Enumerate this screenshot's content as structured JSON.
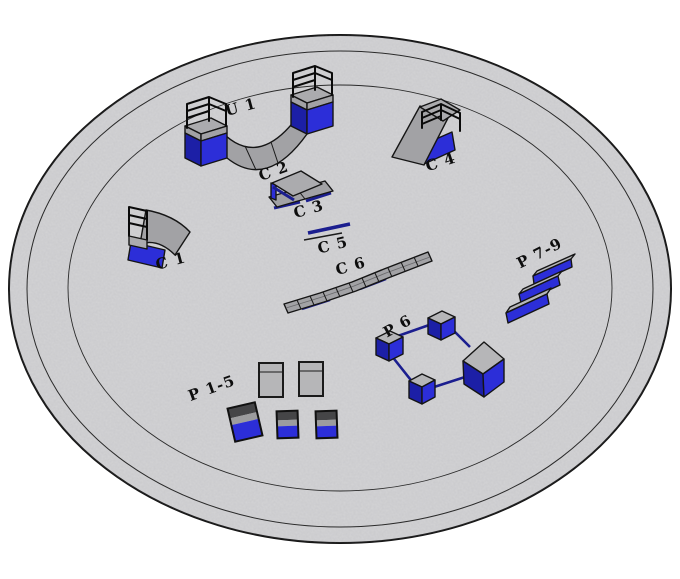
{
  "figure": {
    "title": "3D layout of skatepark equipment on circular pad",
    "platform": {
      "shape": "ellipse",
      "fill": "#d4d4d6",
      "ring_count": 2
    },
    "colors": {
      "platform_fill": "#d4d4d6",
      "equipment_gray": "#a2a2a5",
      "cube_top_gray": "#b6b6b8",
      "equipment_blue": "#2c2ed8",
      "equipment_blue_dark": "#1c1fa6",
      "rail_navy": "#1b1e8f",
      "outline_black": "#151515",
      "label_color": "#0d0d0d"
    },
    "labels": {
      "u1": "U 1",
      "c1": "C 1",
      "c2": "C 2",
      "c3": "C 3",
      "c4": "C 4",
      "c5": "C 5",
      "c6": "C 6",
      "p6": "P 6",
      "p7_9": "P 7-9",
      "p1_5": "P 1-5"
    }
  }
}
